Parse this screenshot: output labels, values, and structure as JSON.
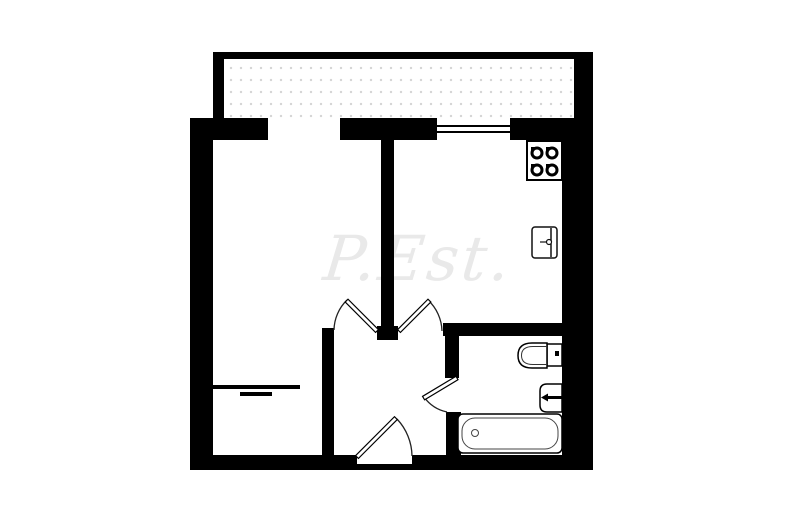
{
  "document": {
    "type": "apartment floor plan drawing",
    "watermark": {
      "text": "P.Est."
    }
  },
  "colors": {
    "background": "#ffffff",
    "walls": "#000000",
    "watermark": "#e9e9e9",
    "fixture_outline": "#111111",
    "door_arc": "#222222",
    "balcony_dots": "#d4d4d4"
  },
  "icons": [
    {
      "name": "stove-icon"
    },
    {
      "name": "kitchen-sink-icon"
    },
    {
      "name": "toilet-icon"
    },
    {
      "name": "washbasin-icon"
    },
    {
      "name": "bathtub-icon"
    },
    {
      "name": "window-icon"
    },
    {
      "name": "door-swing-icon"
    }
  ]
}
